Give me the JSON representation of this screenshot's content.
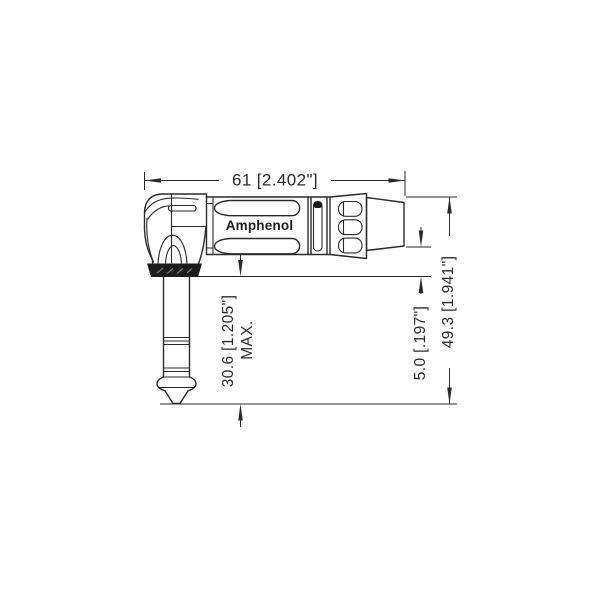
{
  "drawing": {
    "brand": "Amphenol",
    "dimensions": {
      "overall_length": "61 [2.402\"]",
      "plug_height": "30.6 [1.205\"]",
      "plug_height_qualifier": "MAX.",
      "body_to_plug_offset": "5.0 [.197\"]",
      "overall_height": "49.3 [1.941\"]"
    },
    "colors": {
      "line": "#2a2a2a",
      "background": "#ffffff",
      "nut_fill": "#1c1c1c"
    }
  }
}
